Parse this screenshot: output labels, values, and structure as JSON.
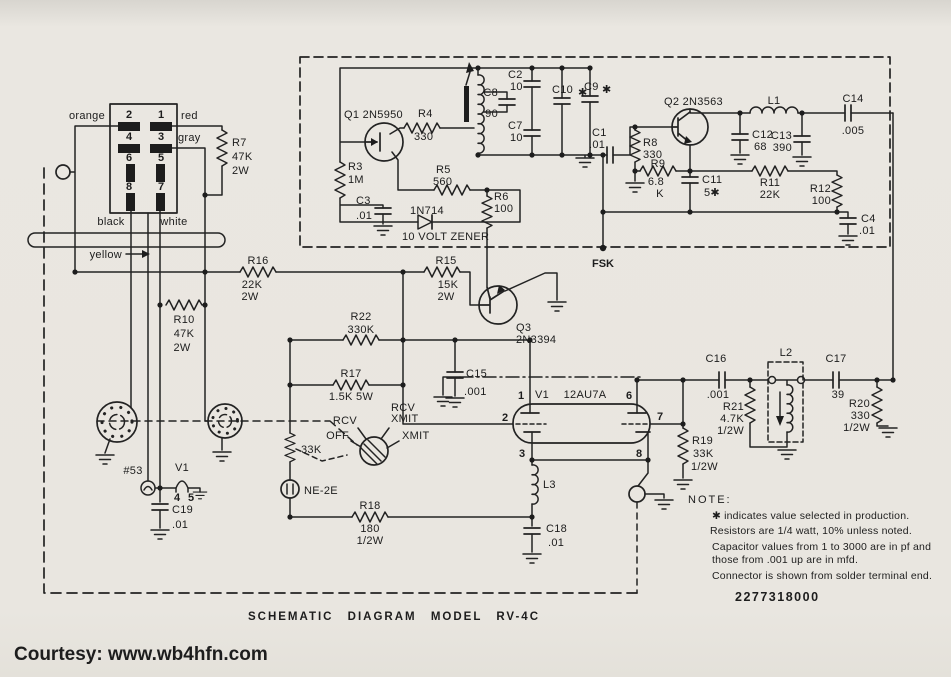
{
  "colors": {
    "paper": "#e9e6e0",
    "ink": "#1d1d1d",
    "courtesy": "#4c1026"
  },
  "connector": {
    "pins": {
      "p1": "1",
      "p2": "2",
      "p3": "3",
      "p4": "4",
      "p5": "5",
      "p6": "6",
      "p7": "7",
      "p8": "8"
    },
    "wires": {
      "orange": "orange",
      "red": "red",
      "gray": "gray",
      "black": "black",
      "white": "white",
      "yellow": "yellow"
    }
  },
  "labels": {
    "r3": [
      "R3",
      "1M"
    ],
    "r4": [
      "R4",
      "330"
    ],
    "r5": [
      "R5",
      "560"
    ],
    "r6": [
      "R6",
      "100"
    ],
    "r7": [
      "R7",
      "47K",
      "2W"
    ],
    "r8": [
      "R8",
      "330"
    ],
    "r9": [
      "R9",
      "6.8",
      "K"
    ],
    "r10": [
      "R10",
      "47K",
      "2W"
    ],
    "r11": [
      "R11",
      "22K"
    ],
    "r12": [
      "R12",
      "100"
    ],
    "r15": [
      "R15",
      "15K",
      "2W"
    ],
    "r16": [
      "R16",
      "22K",
      "2W"
    ],
    "r17": [
      "R17",
      "1.5K 5W"
    ],
    "r18": [
      "R18",
      "180",
      "1/2W"
    ],
    "r19": [
      "R19",
      "33K",
      "1/2W"
    ],
    "r20": [
      "R20",
      "330",
      "1/2W"
    ],
    "r21": [
      "R21",
      "4.7K",
      "1/2W"
    ],
    "r22": [
      "R22",
      "330K"
    ],
    "r_sw": "33K",
    "c1": [
      "C1",
      ".01"
    ],
    "c2": [
      "C2",
      "10"
    ],
    "c3": [
      "C3",
      ".01"
    ],
    "c4": [
      "C4",
      ".01"
    ],
    "c7": [
      "C7",
      "10"
    ],
    "c8": [
      "C8",
      "90"
    ],
    "c9": [
      "C9",
      "✱"
    ],
    "c10": [
      "C10",
      "✱"
    ],
    "c11": [
      "C11",
      "5✱"
    ],
    "c12": [
      "C12",
      "68"
    ],
    "c13": [
      "C13",
      "390"
    ],
    "c14": [
      "C14",
      ".005"
    ],
    "c15": [
      "C15",
      ".001"
    ],
    "c16": [
      "C16",
      ".001"
    ],
    "c17": [
      "C17",
      "39"
    ],
    "c18": [
      "C18",
      ".01"
    ],
    "c19": [
      "C19",
      ".01"
    ],
    "l1": "L1",
    "l2": "L2",
    "l3": "L3",
    "q1": "Q1 2N5950",
    "q2": "Q2 2N3563",
    "q3": [
      "Q3",
      "2N3394"
    ],
    "zener": [
      "1N714",
      "10 VOLT ZENER"
    ],
    "fsk": "FSK",
    "ne2e": "NE-2E",
    "lamp": "#53",
    "heater": {
      "name": "V1",
      "p4": "4",
      "p5": "5"
    },
    "tube": {
      "name": "V1",
      "type": "12AU7A",
      "p1": "1",
      "p2": "2",
      "p3": "3",
      "p6": "6",
      "p7": "7",
      "p8": "8"
    },
    "switch": {
      "rcv": "RCV",
      "rcv_xmit_1": "RCV",
      "rcv_xmit_2": "XMIT",
      "off": "OFF",
      "xmit": "XMIT"
    }
  },
  "note": {
    "head": "NOTE:",
    "lines": [
      "✱ indicates value selected in production.",
      "Resistors are 1/4 watt, 10% unless noted.",
      "Capacitor values from 1 to 3000 are in pf and",
      "those from .001 up are in mfd.",
      "Connector is shown from solder terminal end."
    ]
  },
  "footer": {
    "part_number": "2277318000",
    "title": "SCHEMATIC DIAGRAM MODEL RV-4C",
    "courtesy": "Courtesy: www.wb4hfn.com"
  }
}
